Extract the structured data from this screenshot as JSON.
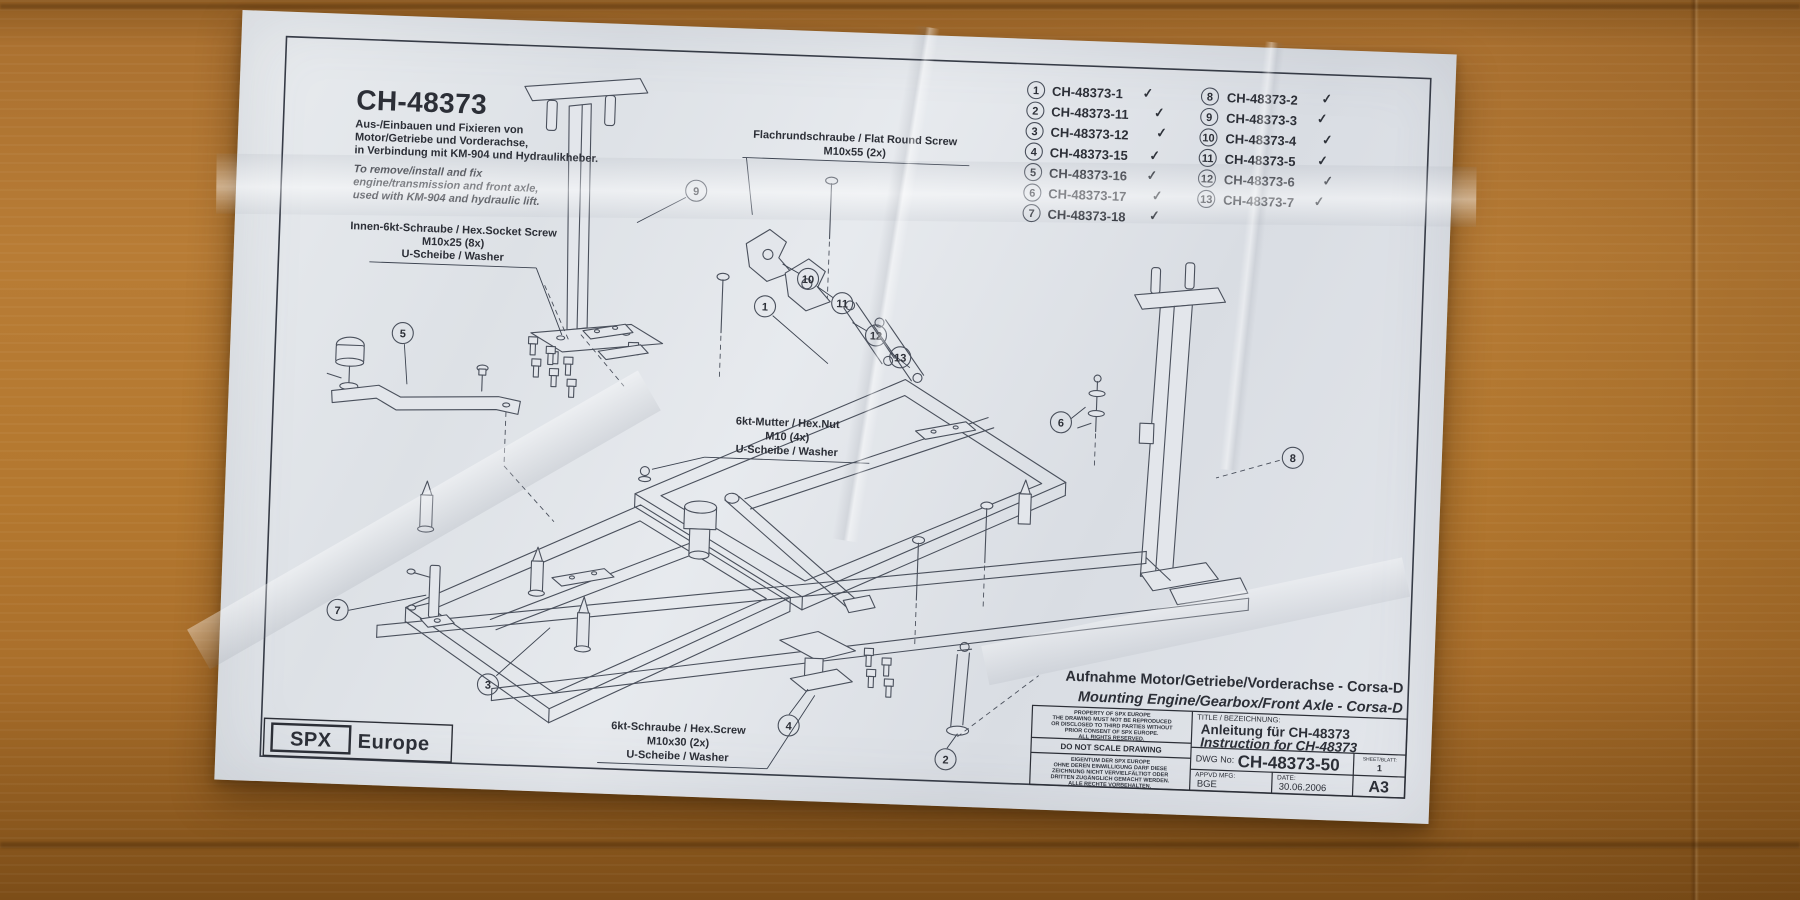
{
  "colors": {
    "cardboard": "#b4782f",
    "paper": "#e4e7ec",
    "ink": "#2c2f37",
    "drawing_line": "#4a505c"
  },
  "paper": {
    "header": {
      "title": "CH-48373",
      "subtitle_de": [
        "Aus-/Einbauen und Fixieren von",
        "Motor/Getriebe und Vorderachse,",
        "in Verbindung mit KM-904 und Hydraulikheber."
      ],
      "subtitle_en": [
        "To remove/install and fix",
        "engine/transmission and front axle,",
        "used with KM-904 and hydraulic lift."
      ]
    },
    "parts": [
      {
        "num": "1",
        "code": "CH-48373-1",
        "check": "✓"
      },
      {
        "num": "2",
        "code": "CH-48373-11",
        "check": "✓"
      },
      {
        "num": "3",
        "code": "CH-48373-12",
        "check": "✓"
      },
      {
        "num": "4",
        "code": "CH-48373-15",
        "check": "✓"
      },
      {
        "num": "5",
        "code": "CH-48373-16",
        "check": "✓"
      },
      {
        "num": "6",
        "code": "CH-48373-17",
        "check": "✓"
      },
      {
        "num": "7",
        "code": "CH-48373-18",
        "check": "✓"
      },
      {
        "num": "8",
        "code": "CH-48373-2",
        "check": "✓"
      },
      {
        "num": "9",
        "code": "CH-48373-3",
        "check": "✓"
      },
      {
        "num": "10",
        "code": "CH-48373-4",
        "check": "✓"
      },
      {
        "num": "11",
        "code": "CH-48373-5",
        "check": "✓"
      },
      {
        "num": "12",
        "code": "CH-48373-6",
        "check": "✓"
      },
      {
        "num": "13",
        "code": "CH-48373-7",
        "check": "✓"
      }
    ],
    "labels": [
      {
        "lines": [
          "Flachrundschraube / Flat Round Screw",
          "M10x55  (2x)"
        ]
      },
      {
        "lines": [
          "Innen-6kt-Schraube / Hex.Socket Screw",
          "M10x25  (8x)",
          "U-Scheibe / Washer"
        ]
      },
      {
        "lines": [
          "6kt-Mutter / Hex.Nut",
          "M10 (4x)",
          "U-Scheibe / Washer"
        ]
      },
      {
        "lines": [
          "6kt-Schraube / Hex.Screw",
          "M10x30  (2x)",
          "U-Scheibe / Washer"
        ]
      }
    ],
    "diagram_callouts": [
      {
        "num": "9"
      },
      {
        "num": "10"
      },
      {
        "num": "11"
      },
      {
        "num": "12"
      },
      {
        "num": "13"
      },
      {
        "num": "1"
      },
      {
        "num": "5"
      },
      {
        "num": "6"
      },
      {
        "num": "8"
      },
      {
        "num": "7"
      },
      {
        "num": "3"
      },
      {
        "num": "4"
      },
      {
        "num": "2"
      }
    ],
    "caption": {
      "de": "Aufnahme Motor/Getriebe/Vorderachse - Corsa-D",
      "en": "Mounting Engine/Gearbox/Front Axle - Corsa-D"
    },
    "title_block": {
      "property_en": [
        "PROPERTY OF SPX EUROPE",
        "THE DRAWING MUST NOT BE REPRODUCED",
        "OR DISCLOSED TO THIRD PARTIES WITHOUT",
        "PRIOR CONSENT OF SPX EUROPE.",
        "ALL RIGHTS RESERVED."
      ],
      "do_not_scale": "DO NOT SCALE DRAWING",
      "property_de": [
        "EIGENTUM DER SPX EUROPE",
        "OHNE DEREN EINWILLIGUNG DARF DIESE",
        "ZEICHNUNG NICHT VERVIELFÄLTIGT ODER",
        "DRITTEN ZUGÄNGLICH GEMACHT WERDEN.",
        "ALLE RECHTE VORBEHALTEN."
      ],
      "title_label": "TITLE / BEZEICHNUNG:",
      "title_de": "Anleitung für CH-48373",
      "title_en": "Instruction for CH-48373",
      "dwg_label": "DWG No:",
      "dwg_value": "CH-48373-50",
      "sheet_label": "SHEET/BLATT:",
      "sheet_value": "1",
      "appvd_label": "APPVD MFG:",
      "appvd_value": "BGE",
      "date_label": "DATE:",
      "date_value": "30.06.2006",
      "format_value": "A3"
    },
    "logo": {
      "box": "SPX",
      "suffix": "Europe"
    }
  }
}
